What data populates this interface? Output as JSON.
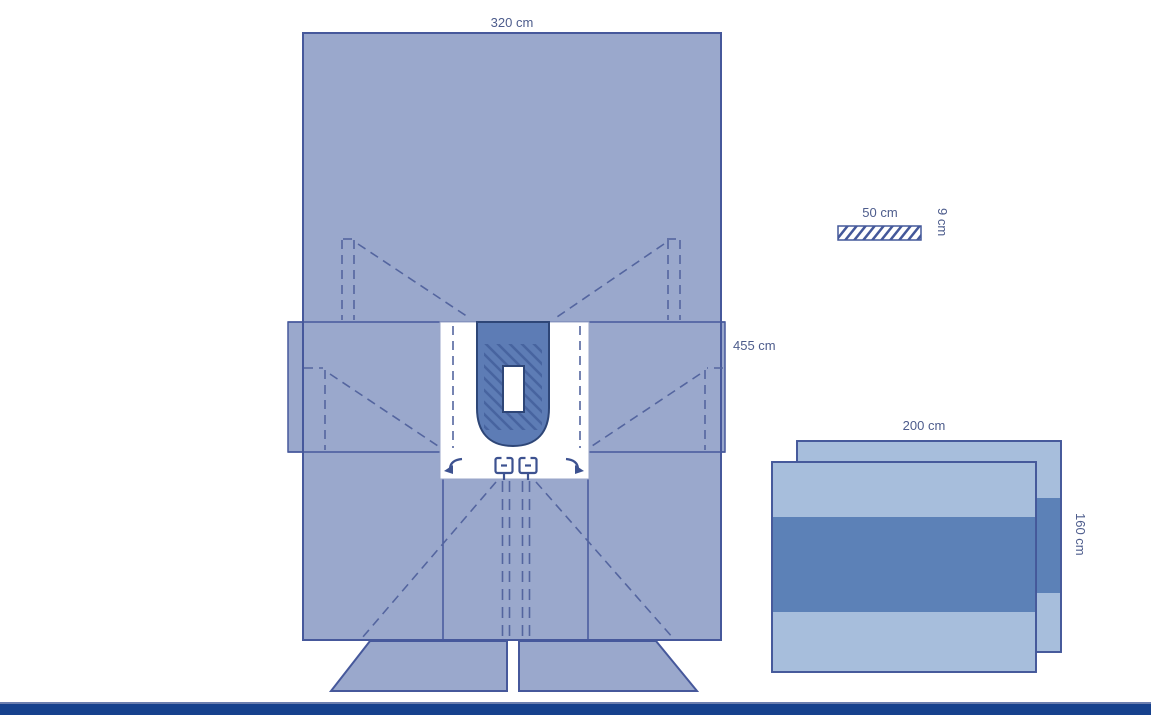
{
  "diagram_type": "surgical-drape-technical-diagram",
  "labels": {
    "main_width": "320 cm",
    "main_length": "455 cm",
    "scale_width": "50 cm",
    "scale_height": "9 cm",
    "side_width": "200 cm",
    "side_height": "160 cm"
  },
  "colors": {
    "drape_light": "#9aa8cc",
    "drape_outline": "#46589b",
    "incise_pad": "#5d7cb5",
    "incise_pad_outline": "#2e4677",
    "hatch": "#47649f",
    "fenestration_zone": "#ffffff",
    "side_drape_light": "#a7bedc",
    "side_drape_band": "#5c81b7",
    "dash_marks": "#54659f",
    "label_text": "#4d5c8c",
    "footer_navy": "#16418d",
    "background": "#ffffff"
  },
  "icons": {
    "left_arrow": "curved-arrow-left-icon",
    "right_arrow": "curved-arrow-right-icon",
    "tube_holder": "tube-holder-icon"
  }
}
